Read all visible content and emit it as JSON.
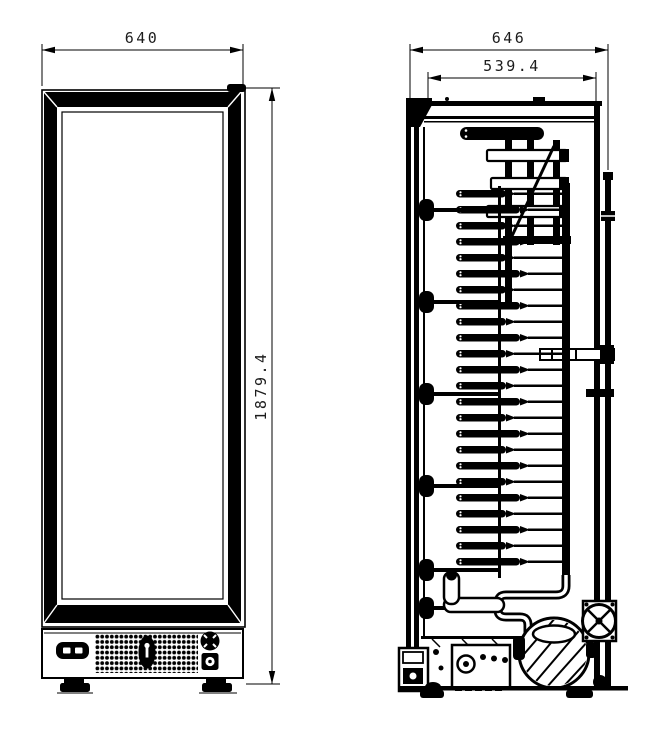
{
  "canvas": {
    "background": "#ffffff",
    "ink": "#000000"
  },
  "drawing": {
    "type": "technical-drawing",
    "subject": "single-glass-door-upright-cooler",
    "views": {
      "front": {
        "label": "front-view"
      },
      "side": {
        "label": "side-section-view"
      }
    }
  },
  "dimensions": {
    "front_width": "640",
    "overall_height": "1879.4",
    "overall_depth": "646",
    "inner_depth": "539.4"
  }
}
